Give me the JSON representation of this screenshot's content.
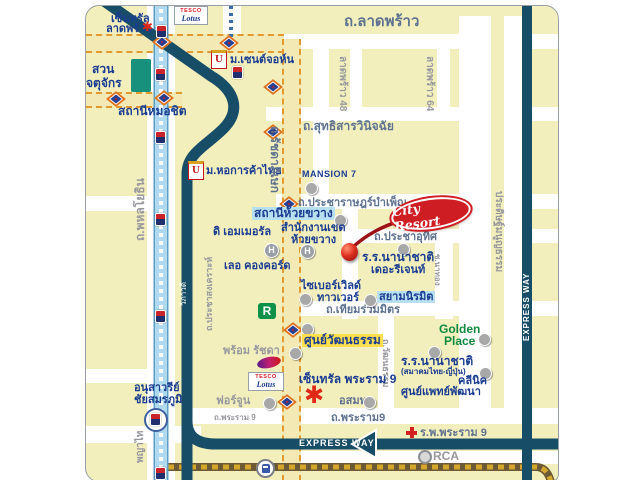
{
  "labels": {
    "ladprao": "ถ.ลาดพร้าว",
    "sutthisan": "ถ.สุทธิสารวินิจฉัย",
    "bamphen": "ถ.ประชาราษฎร์บำเพ็ญ",
    "prachauthit": "ถ.ประชาอุทิศ",
    "thiamruammit": "ถ.เทียมร่วมมิตร",
    "rama9": "ถ.พระราม9",
    "rama9_w": "ถ.พระราม 9",
    "ratchada": "ถ.รัชดาภิเษก",
    "ladprao48": "ลาดพร้าว 48",
    "ladprao64": "ลาดพร้าว 64",
    "pradit": "ประดิษฐ์มนูญธรรม",
    "watthanatham": "ถ.วัฒนธรรม",
    "nathong": "ซ.นาทอง",
    "phahonyothin": "ถ.พหลโยธิน",
    "phayathai": "พญาไท",
    "prachasongkhro": "ถ.ประชาสงเคราะห์",
    "vibhavadi": "วิภาวดี",
    "expway": "EXPRESS WAY",
    "expway_v": "EXPRESS WAY"
  },
  "places": {
    "central_ladprao_1": "เซ็นทรัล",
    "central_ladprao_2": "ลาดพร้าว",
    "chatuchak_1": "สวน",
    "chatuchak_2": "จตุจักร",
    "mochit": "สถานีหมอชิต",
    "stjohn": "ม.เซนต์จอห์น",
    "utcc": "ม.หอการค้าไทย",
    "mansion7": "MANSION 7",
    "huaikhwang": "สถานีห้วยขวาง",
    "district_1": "สำนักงานเขต",
    "district_2": "ห้วยขวาง",
    "emerald": "ดิ เอมเมอรัล",
    "concorde": "เลอ คองคอร์ด",
    "regent_1": "ร.ร.นานาชาติ",
    "regent_2": "เดอะรีเจนท์",
    "cyber_1": "ไซเบอร์เวิลด์",
    "cyber_2": "ทาวเวอร์",
    "siamniramit": "สยามนิรมิต",
    "culture": "ศูนย์วัฒนธรรม",
    "prompt": "พร้อม รัชดา",
    "fortune": "ฟอร์จูน",
    "central_rama9": "เซ็นทรัล พระราม 9",
    "mcot": "อสมท.",
    "tjschool_1": "ร.ร.นานาชาติ",
    "tjschool_2": "(สมาคมไทย-ญี่ปุ่น)",
    "golden_1": "Golden",
    "golden_2": "Place",
    "clinic_1": "คลีนิค",
    "clinic_2": "ศูนย์แพทย์พัฒนา",
    "hospital": "ร.พ.พระราม 9",
    "rca": "RCA",
    "victory_1": "อนุสาวรีย์",
    "victory_2": "ชัยสมรภูมิ"
  },
  "logos": {
    "city_resort": "City Resort",
    "tesco": "TESCO",
    "lotus": "Lotus"
  },
  "colors": {
    "navy_road": "#174d66",
    "bts_blue": "#aed9ee",
    "road_orange": "#e09a30",
    "place_blue": "#1b3d91",
    "road_label": "#5f7390",
    "resort_red": "#cf1d24",
    "highlight_blue": "#b8e0f0",
    "highlight_yellow": "#ffdf4d"
  }
}
